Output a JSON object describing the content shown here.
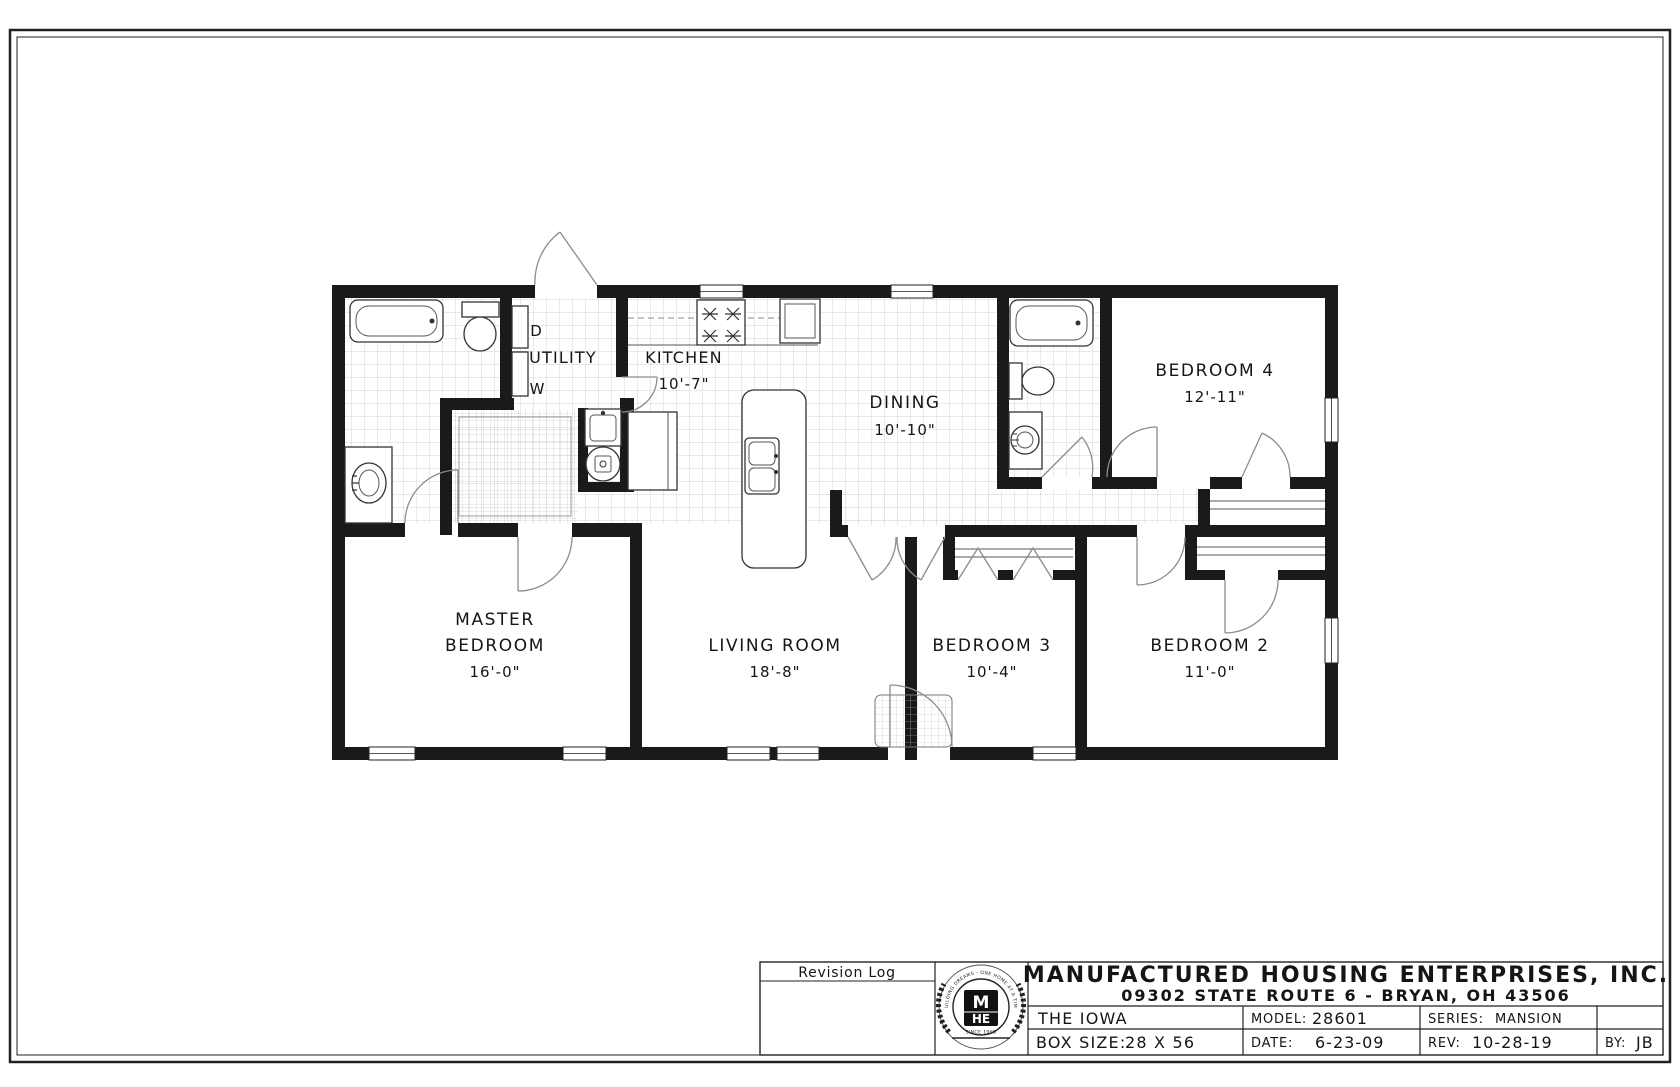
{
  "floor_plan": {
    "rooms": {
      "utility": {
        "label": "UTILITY"
      },
      "kitchen": {
        "label": "KITCHEN",
        "dim": "10'-7\""
      },
      "dining": {
        "label": "DINING",
        "dim": "10'-10\""
      },
      "bedroom4": {
        "label": "BEDROOM 4",
        "dim": "12'-11\""
      },
      "master": {
        "line1": "MASTER",
        "line2": "BEDROOM",
        "dim": "16'-0\""
      },
      "living": {
        "label": "LIVING ROOM",
        "dim": "18'-8\""
      },
      "bedroom3": {
        "label": "BEDROOM 3",
        "dim": "10'-4\""
      },
      "bedroom2": {
        "label": "BEDROOM 2",
        "dim": "11'-0\""
      }
    },
    "appliances": {
      "dryer": "D",
      "washer": "W"
    }
  },
  "title_block": {
    "revision_log": "Revision Log",
    "company": "MANUFACTURED HOUSING ENTERPRISES, INC.",
    "address": "09302 STATE ROUTE 6 - BRYAN, OH 43506",
    "plan_name": "THE IOWA",
    "model_label": "MODEL:",
    "model": "28601",
    "series_label": "SERIES:",
    "series": "MANSION",
    "box_size_label": "BOX SIZE:",
    "box_size": "28 X 56",
    "date_label": "DATE:",
    "date": "6-23-09",
    "rev_label": "REV:",
    "rev": "10-28-19",
    "by_label": "BY:",
    "by": "JB",
    "logo": {
      "monogram_top": "M",
      "monogram_bottom": "HE",
      "tagline": "BUILDING DREAMS - ONE HOME AT A TIME",
      "since": "SINCE 1965"
    }
  },
  "colors": {
    "wall": "#1a1a1a",
    "tile_line": "#c9c9c9",
    "door_swing": "#8c8c8c"
  }
}
